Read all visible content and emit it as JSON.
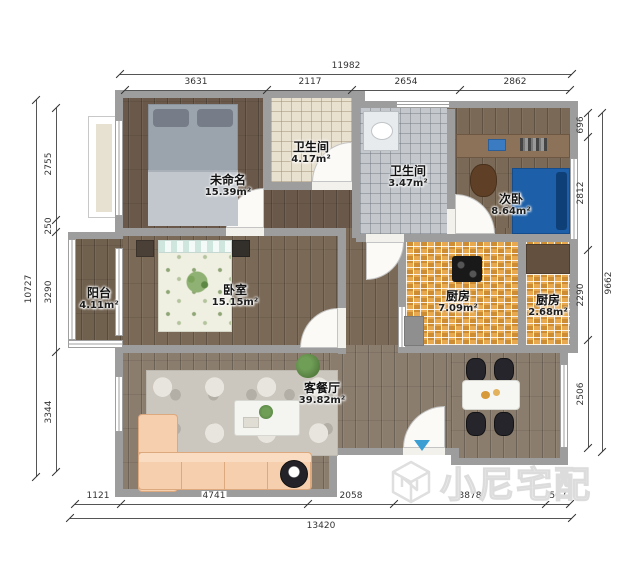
{
  "plan": {
    "rooms": {
      "bedroom_unnamed": {
        "name": "未命名",
        "area": "15.39m²"
      },
      "bathroom_main": {
        "name": "卫生间",
        "area": "4.17m²"
      },
      "bathroom_second": {
        "name": "卫生间",
        "area": "3.47m²"
      },
      "bedroom_second": {
        "name": "次卧",
        "area": "8.64m²"
      },
      "kitchen_main": {
        "name": "厨房",
        "area": "7.09m²"
      },
      "kitchen_small": {
        "name": "厨房",
        "area": "2.68m²"
      },
      "balcony": {
        "name": "阳台",
        "area": "4.11m²"
      },
      "bedroom_master": {
        "name": "卧室",
        "area": "15.15m²"
      },
      "living_dining": {
        "name": "客餐厅",
        "area": "39.82m²"
      }
    }
  },
  "dimensions": {
    "top": {
      "total": "11982",
      "segments": [
        "3631",
        "2117",
        "2654",
        "2862"
      ]
    },
    "bottom": {
      "total": "13420",
      "segments": [
        "1121",
        "4741",
        "2058",
        "3878",
        "507"
      ]
    },
    "left": {
      "total": "10727",
      "segments": [
        "2755",
        "250",
        "3290",
        "3344"
      ]
    },
    "right": {
      "total": "9662",
      "segments": [
        "696",
        "2812",
        "2290",
        "2506"
      ]
    }
  },
  "watermark": {
    "brand": "小尼宅配",
    "logo": "cube-logo"
  },
  "colors": {
    "wall": "#9d9d9d",
    "kitchen-orange-a": "#e8a94e",
    "kitchen-orange-b": "#cf8d33",
    "bed-blue": "#1d5fa8",
    "sofa-peach": "#f6cfae",
    "entry-arrow": "#3b9fd4",
    "dim-line": "#555555"
  }
}
